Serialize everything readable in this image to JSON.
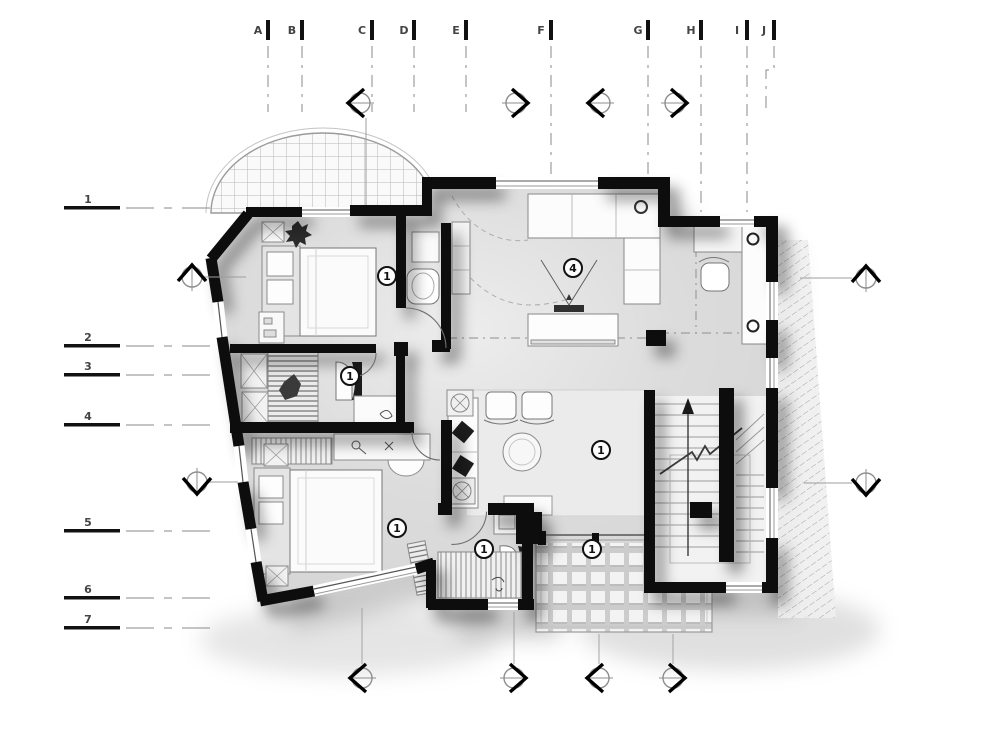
{
  "drawing": {
    "type": "architectural-floor-plan",
    "floor_label": "upper floor plan"
  },
  "grid": {
    "columns": [
      {
        "label": "A"
      },
      {
        "label": "B"
      },
      {
        "label": "C"
      },
      {
        "label": "D"
      },
      {
        "label": "E"
      },
      {
        "label": "F"
      },
      {
        "label": "G"
      },
      {
        "label": "H"
      },
      {
        "label": "I"
      },
      {
        "label": "J"
      }
    ],
    "rows": [
      {
        "label": "1"
      },
      {
        "label": "2"
      },
      {
        "label": "3"
      },
      {
        "label": "4"
      },
      {
        "label": "5"
      },
      {
        "label": "6"
      },
      {
        "label": "7"
      }
    ]
  },
  "markers": {
    "top": [
      {
        "dir": "left"
      },
      {
        "dir": "right"
      },
      {
        "dir": "left"
      },
      {
        "dir": "right"
      }
    ],
    "bottom": [
      {
        "dir": "left"
      },
      {
        "dir": "right"
      },
      {
        "dir": "left"
      },
      {
        "dir": "right"
      }
    ],
    "left": [
      {
        "dir": "up"
      },
      {
        "dir": "down"
      }
    ],
    "right": [
      {
        "dir": "up"
      },
      {
        "dir": "down"
      }
    ]
  },
  "rooms": [
    {
      "name": "bedroom-1",
      "tag": "1"
    },
    {
      "name": "wc",
      "tag": "1"
    },
    {
      "name": "living-room",
      "tag": "4"
    },
    {
      "name": "dining-area",
      "tag": "1"
    },
    {
      "name": "bedroom-2",
      "tag": "1"
    },
    {
      "name": "bathroom",
      "tag": "1"
    },
    {
      "name": "terrace",
      "tag": "1"
    }
  ],
  "colors": {
    "wall": "#0c0c0c",
    "floor": "#d7d7d7",
    "paper": "#ffffff",
    "furniture_line": "#8a8a8a",
    "tile_line": "#b5b5b5"
  }
}
